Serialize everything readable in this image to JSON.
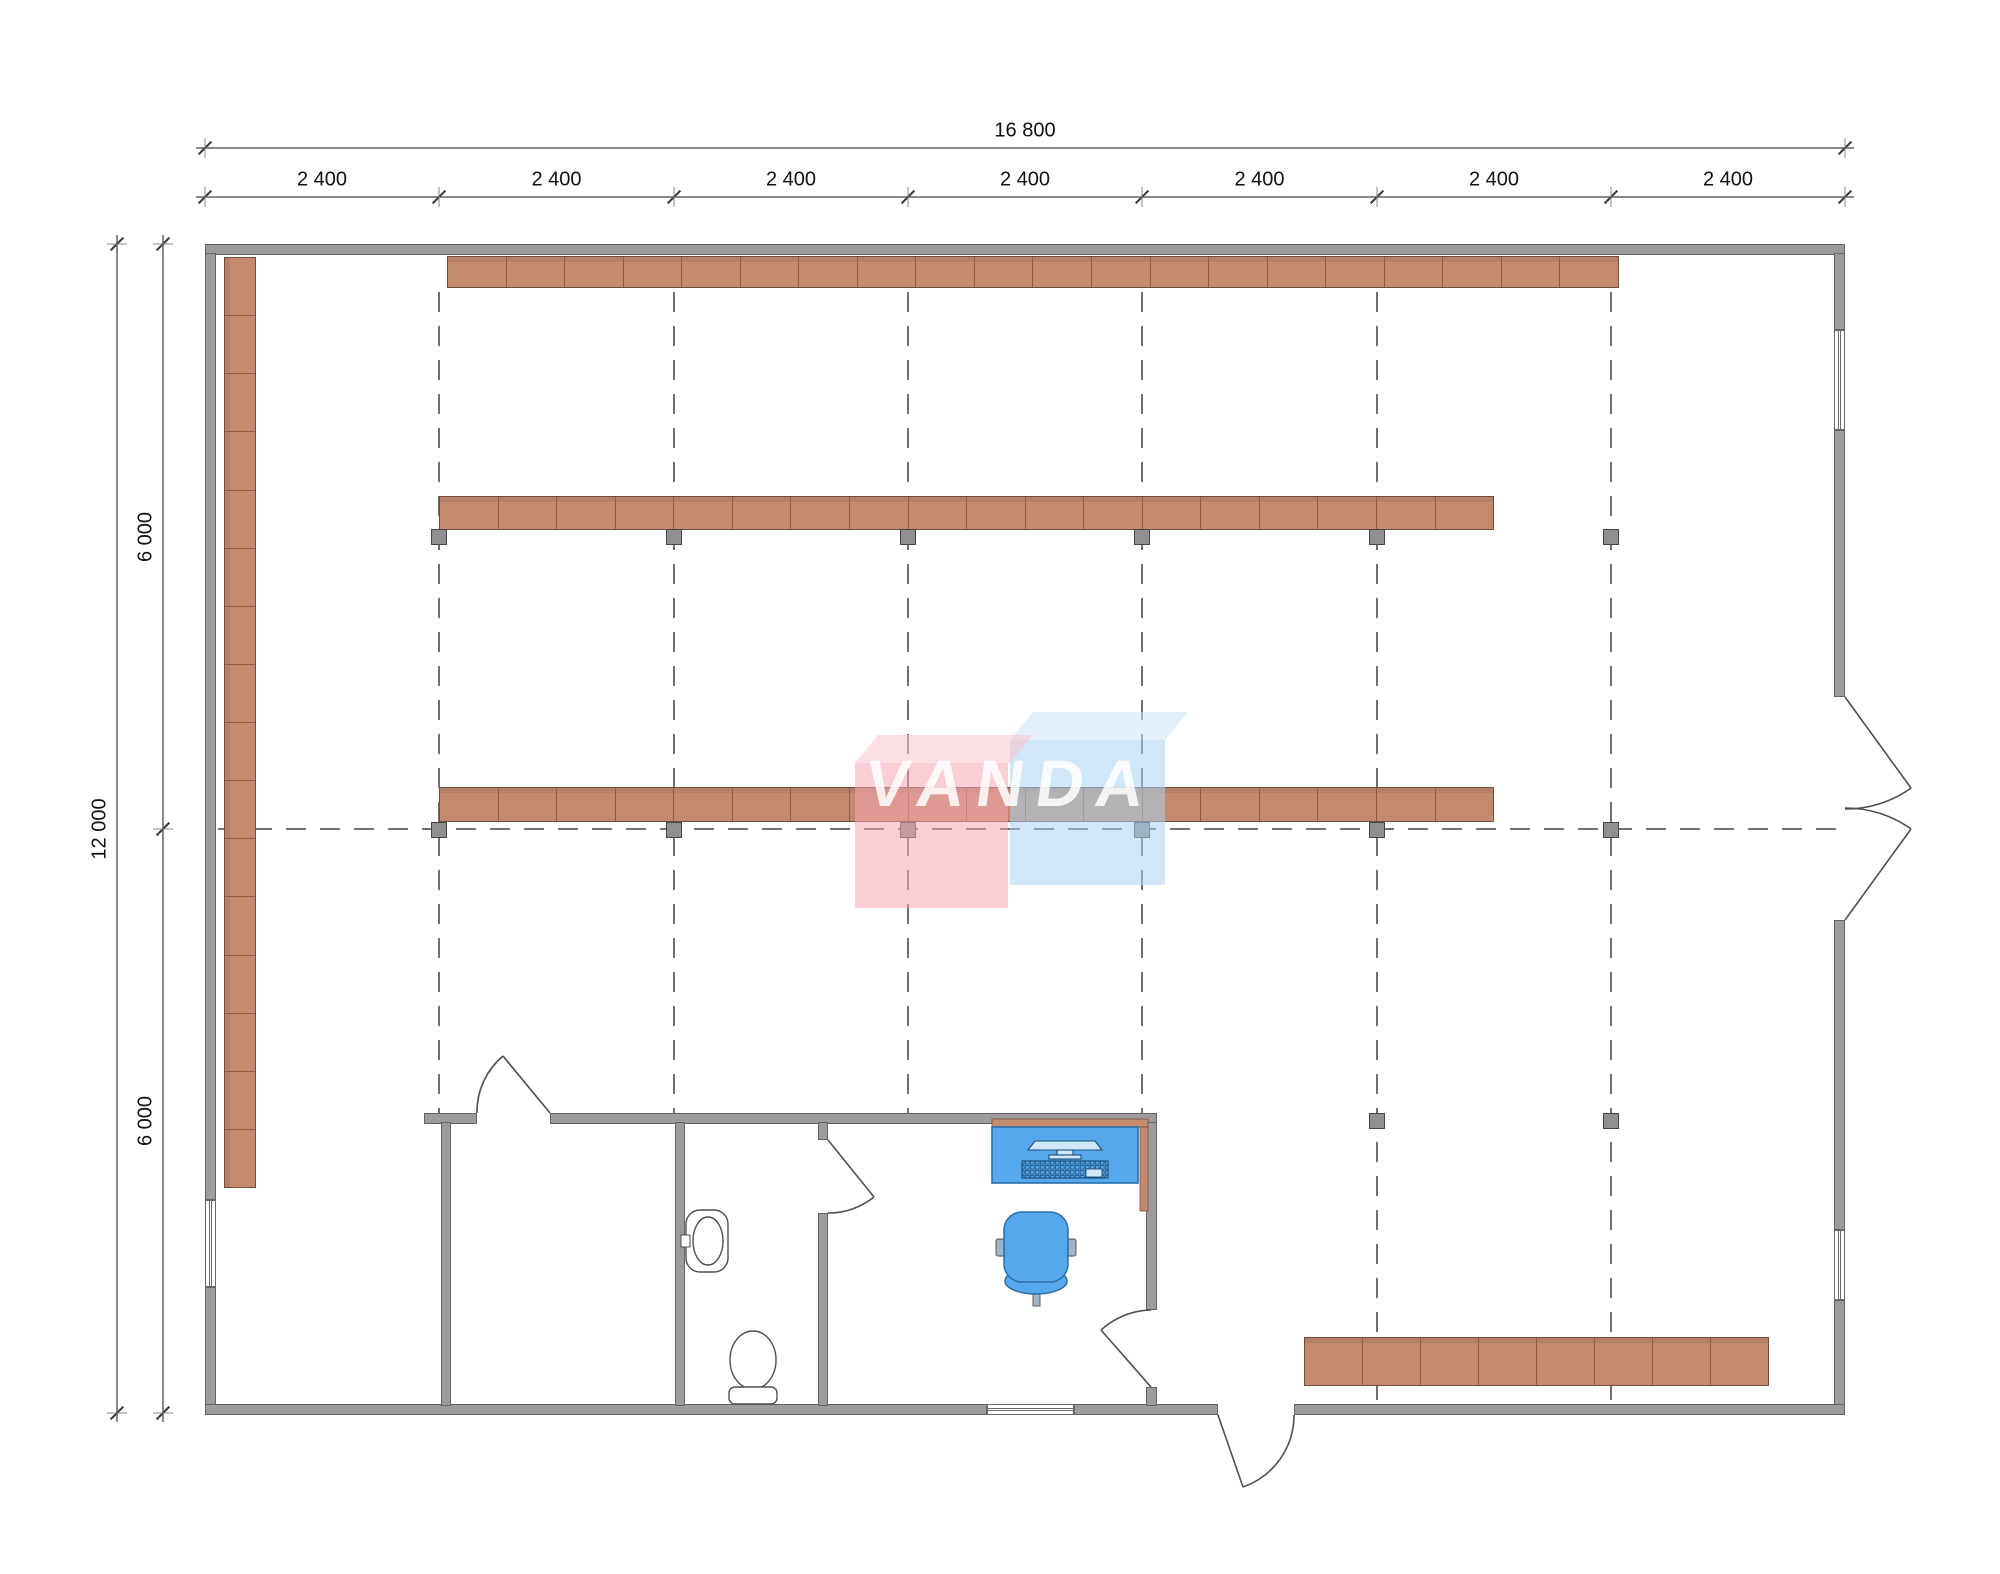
{
  "watermark": {
    "text": "VANDA",
    "pink_front": "rgba(244,166,178,0.55)",
    "pink_top": "rgba(249,194,204,0.55)",
    "blue_front": "rgba(168,211,240,0.55)",
    "blue_top": "rgba(204,230,248,0.55)"
  },
  "colors": {
    "shelf_fill": "#C38A6E",
    "shelf_border": "#6E4F3E",
    "wall_fill": "#9C9C9C",
    "post_fill": "#8F8F8F",
    "furniture_blue": "#54A8EB",
    "grid_dash": "#6f6f6f"
  },
  "dimensions": {
    "top_total": {
      "label": "16 800",
      "y": 148,
      "x1": 205,
      "x2": 1845,
      "label_x": 1025
    },
    "top_bays": {
      "y": 197,
      "ticks": [
        205,
        439,
        674,
        908,
        1142,
        1377,
        1611,
        1845
      ],
      "labels": [
        "2 400",
        "2 400",
        "2 400",
        "2 400",
        "2 400",
        "2 400",
        "2 400"
      ]
    },
    "left_total": {
      "label": "12 000",
      "x": 117,
      "y1": 244,
      "y2": 1413,
      "label_y": 829
    },
    "left_halves": {
      "x": 163,
      "ticks": [
        244,
        829,
        1413
      ],
      "labels": [
        "6 000",
        "6 000"
      ]
    }
  },
  "geometry": {
    "grid_vertical": [
      {
        "x": 439,
        "y1": 292,
        "y2": 1113
      },
      {
        "x": 674,
        "y1": 292,
        "y2": 1113
      },
      {
        "x": 908,
        "y1": 292,
        "y2": 1113
      },
      {
        "x": 1142,
        "y1": 292,
        "y2": 1113
      },
      {
        "x": 1377,
        "y1": 292,
        "y2": 1400
      },
      {
        "x": 1611,
        "y1": 292,
        "y2": 1400
      }
    ],
    "grid_horizontal": [
      {
        "y": 829,
        "x1": 218,
        "x2": 1845
      }
    ],
    "shelf_rows": [
      {
        "name": "shelf-row-top",
        "x": 447,
        "y": 256,
        "length": 1172,
        "depth": 32,
        "segments": 20,
        "vertical": false
      },
      {
        "name": "shelf-row-middle",
        "x": 439,
        "y": 496,
        "length": 1055,
        "depth": 34,
        "segments": 18,
        "vertical": false
      },
      {
        "name": "shelf-row-center",
        "x": 439,
        "y": 787,
        "length": 1055,
        "depth": 35,
        "segments": 18,
        "vertical": false
      },
      {
        "name": "shelf-row-bottom-right",
        "x": 1304,
        "y": 1337,
        "length": 465,
        "depth": 49,
        "segments": 8,
        "vertical": false
      },
      {
        "name": "shelf-column-left",
        "x": 224,
        "y": 257,
        "length": 931,
        "depth": 32,
        "segments": 16,
        "vertical": true
      }
    ],
    "posts": [
      {
        "cx": 439,
        "cy": 537
      },
      {
        "cx": 674,
        "cy": 537
      },
      {
        "cx": 908,
        "cy": 537
      },
      {
        "cx": 1142,
        "cy": 537
      },
      {
        "cx": 1377,
        "cy": 537
      },
      {
        "cx": 1611,
        "cy": 537
      },
      {
        "cx": 439,
        "cy": 830
      },
      {
        "cx": 674,
        "cy": 830
      },
      {
        "cx": 908,
        "cy": 830
      },
      {
        "cx": 1142,
        "cy": 830
      },
      {
        "cx": 1377,
        "cy": 830
      },
      {
        "cx": 1611,
        "cy": 830
      },
      {
        "cx": 1377,
        "cy": 1121
      },
      {
        "cx": 1611,
        "cy": 1121
      }
    ]
  }
}
